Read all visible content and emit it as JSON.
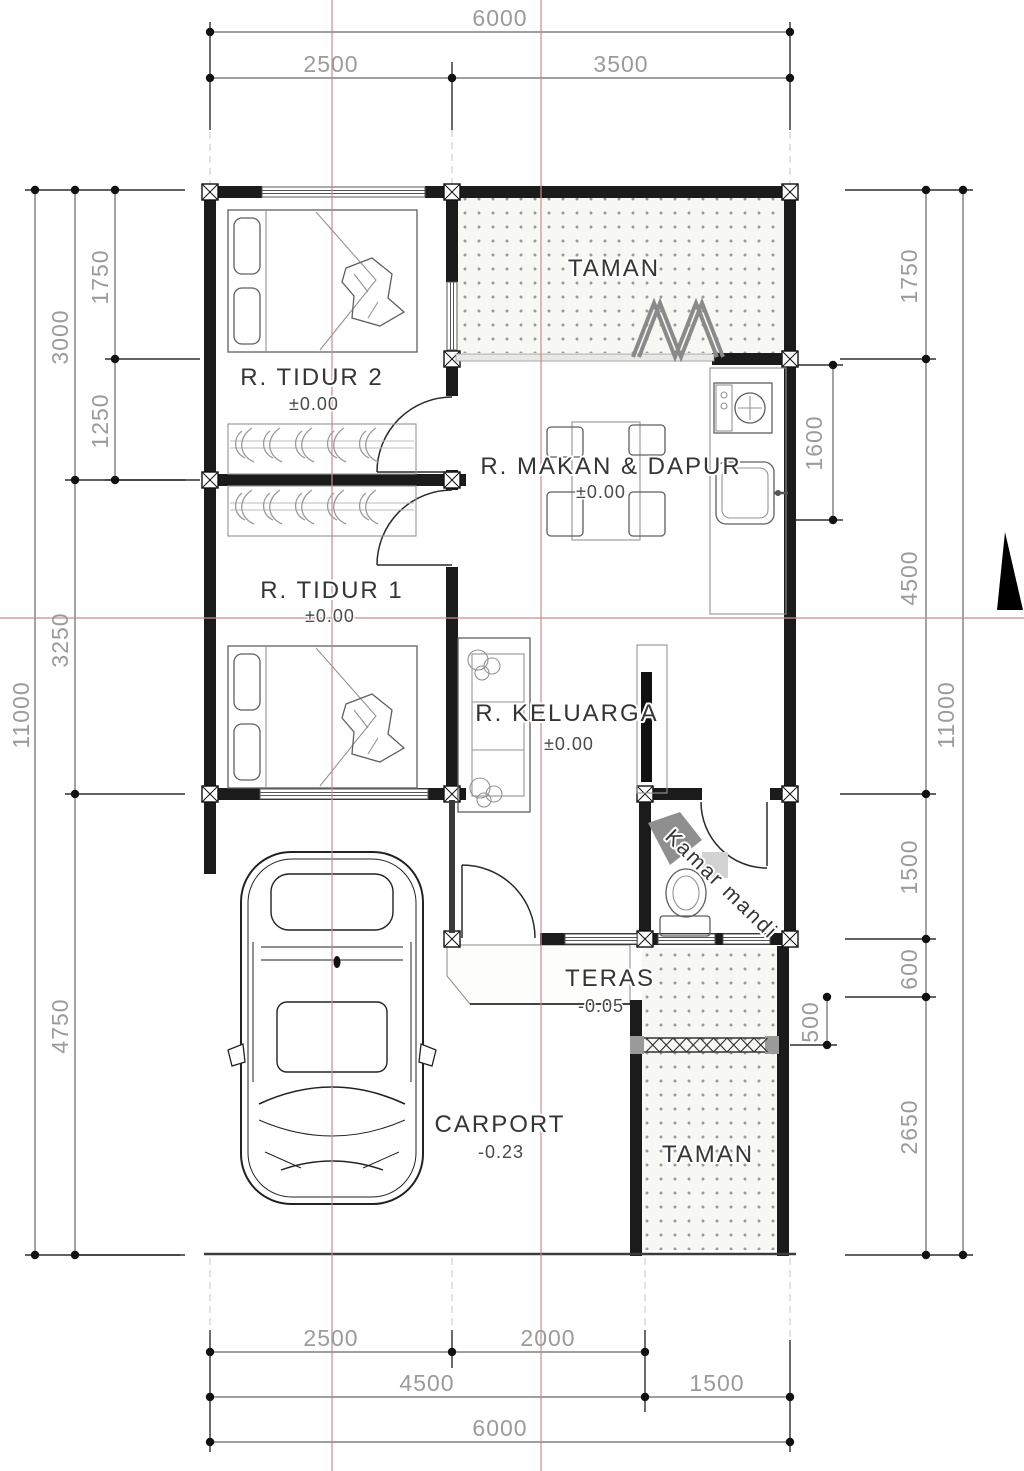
{
  "rooms": {
    "tidur2": {
      "label": "R. TIDUR 2",
      "level": "±0.00"
    },
    "taman_top": {
      "label": "TAMAN"
    },
    "makan_dapur": {
      "label": "R. MAKAN & DAPUR",
      "level": "±0.00"
    },
    "tidur1": {
      "label": "R. TIDUR 1",
      "level": "±0.00"
    },
    "keluarga": {
      "label": "R. KELUARGA",
      "level": "±0.00"
    },
    "kamar_mandi": {
      "label": "Kamar mandi"
    },
    "teras": {
      "label": "TERAS",
      "level": "-0.05"
    },
    "carport": {
      "label": "CARPORT",
      "level": "-0.23"
    },
    "taman_bottom": {
      "label": "TAMAN"
    }
  },
  "dimensions": {
    "top": {
      "total": "6000",
      "left": "2500",
      "right": "3500"
    },
    "bottom": {
      "row1_left": "2500",
      "row1_right": "2000",
      "row2_left": "4500",
      "row2_right": "1500",
      "total": "6000"
    },
    "left": {
      "total": "11000",
      "seg_3000": "3000",
      "seg_3250": "3250",
      "seg_4750": "4750",
      "sub_1750": "1750",
      "sub_1250": "1250"
    },
    "right": {
      "total": "11000",
      "seg_1750": "1750",
      "seg_4500": "4500",
      "seg_1500": "1500",
      "seg_600": "600",
      "seg_2650": "2650",
      "kitchen_1600": "1600",
      "fence_500": "500"
    }
  },
  "colors": {
    "wall": "#1b1b1b",
    "dimension_text": "#9b9b9b",
    "axis_line": "#c98c8c",
    "room_text": "#353535"
  }
}
